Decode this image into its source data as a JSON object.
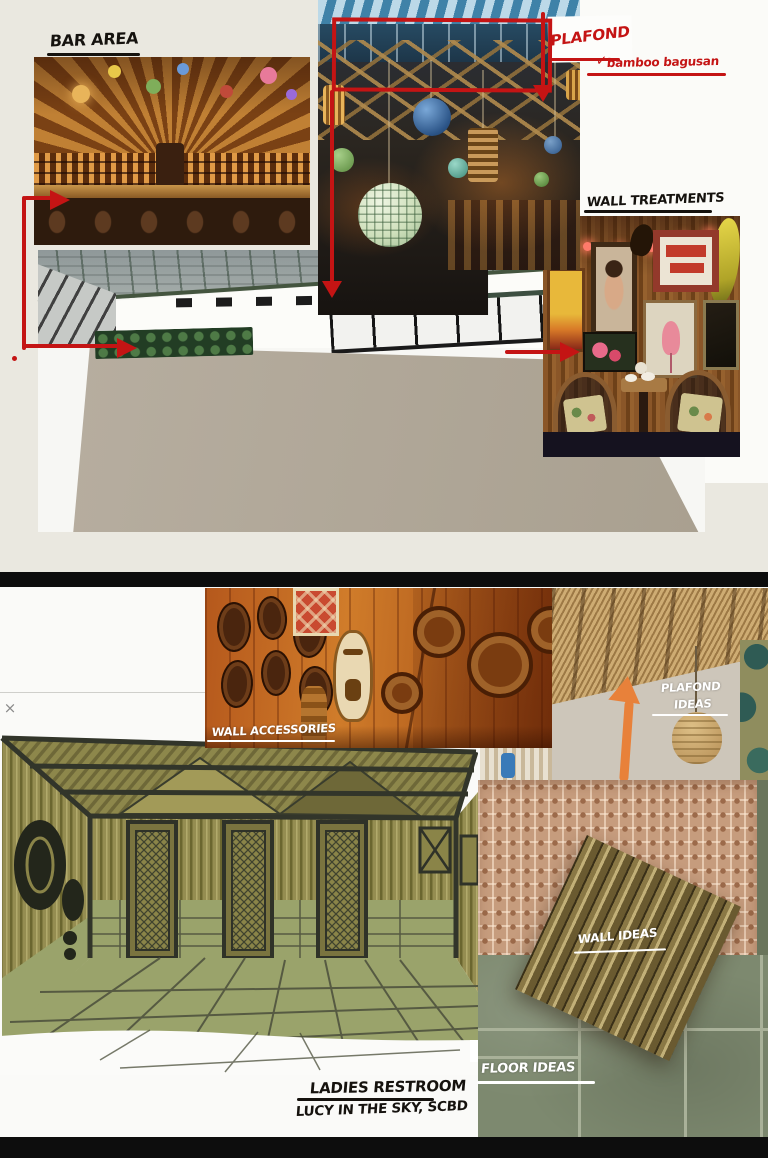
{
  "app": {
    "close_icon": "×"
  },
  "labels": {
    "bar_area": "BAR AREA",
    "plafond": "PLAFOND",
    "plafond_note": "bamboo bagusan",
    "wall_treatments": "WALL TREATMENTS",
    "wall_accessories": "WALL ACCESSORIES",
    "plafond_ideas_line1": "PLAFOND",
    "plafond_ideas_line2": "IDEAS",
    "wall_ideas": "WALL IDEAS",
    "floor_ideas": "FLOOR IDEAS",
    "room_title": "LADIES RESTROOM",
    "room_subtitle": "LUCY IN THE SKY, SCBD"
  },
  "colors": {
    "annotation_red": "#c41414",
    "annotation_orange": "#e8813a",
    "board_background_top": "#eae8e0",
    "board_background_bottom": "#fafaf8",
    "divider_black": "#0d0d0d",
    "tile_green": "#7d896f",
    "sketch_olive": "#958d51"
  },
  "photos": [
    "tiki-bar-interior",
    "hanging-lanterns-ceiling",
    "wall-treatments-corner",
    "sketchup-room-model",
    "tiki-masks-wall",
    "thatch-ceiling-room",
    "cane-webbing-texture",
    "bamboo-slats-panel",
    "green-floor-tiles",
    "ladies-restroom-sketch"
  ]
}
